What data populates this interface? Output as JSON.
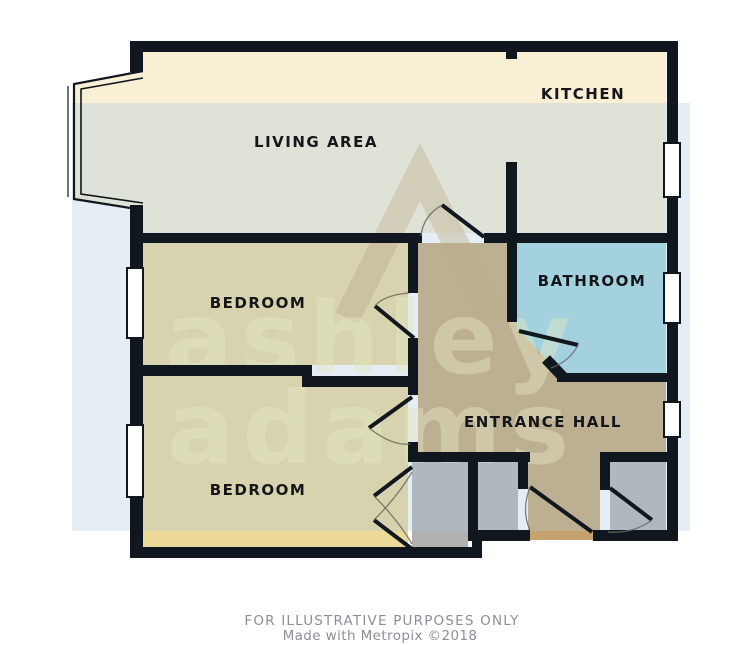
{
  "floorplan": {
    "rooms": [
      {
        "label": "LIVING AREA"
      },
      {
        "label": "KITCHEN"
      },
      {
        "label": "BATHROOM"
      },
      {
        "label": "BEDROOM"
      },
      {
        "label": "BEDROOM"
      },
      {
        "label": "ENTRANCE HALL"
      }
    ],
    "watermark": {
      "line1": "ashley",
      "line2": "adams",
      "logo": "triangle-A-logo"
    },
    "footer": {
      "line1": "FOR ILLUSTRATIVE PURPOSES ONLY",
      "line2": "Made with Metropix ©2018"
    },
    "colors": {
      "wall": "#10171e",
      "floor_living": "#f8efd4",
      "floor_bedroom": "#ecd898",
      "floor_bathroom": "#9fd4de",
      "floor_hall": "#c6a26e",
      "floor_closet": "#b3b0b2",
      "tint_overlay": "rgba(172,202,220,0.32)",
      "watermark_text": "rgba(255,246,185,0.45)",
      "watermark_logo": "rgba(196,158,100,0.40)",
      "window_fill": "#ffffff",
      "arc": "#6b6b60",
      "label": "#15161a",
      "footer_text": "#8b9096"
    }
  }
}
